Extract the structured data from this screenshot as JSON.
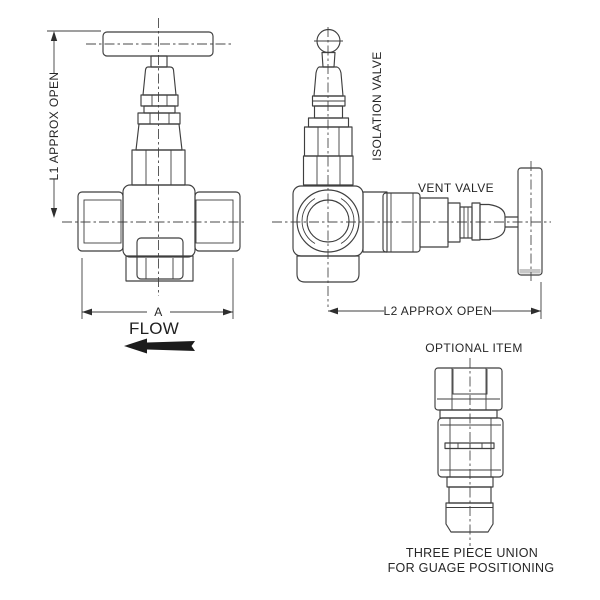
{
  "colors": {
    "background": "#ffffff",
    "line": "#3f3f3f",
    "text": "#262626",
    "flow_arrow_fill": "#1c1c1c"
  },
  "views": {
    "needle_valve_front": {
      "dim_l1": "L1 APPROX OPEN",
      "dim_a": "A",
      "flow_label": "FLOW"
    },
    "isolation_valve_side": {
      "isolation_label": "ISOLATION VALVE",
      "vent_label": "VENT VALVE",
      "dim_l2": "L2 APPROX OPEN"
    },
    "optional_item": {
      "heading": "OPTIONAL ITEM",
      "caption_line1": "THREE PIECE UNION",
      "caption_line2": "FOR GUAGE POSITIONING"
    }
  },
  "icons": {
    "flow_arrow": "solid-left-arrow",
    "dimension_arrowheads": "filled-triangle"
  }
}
